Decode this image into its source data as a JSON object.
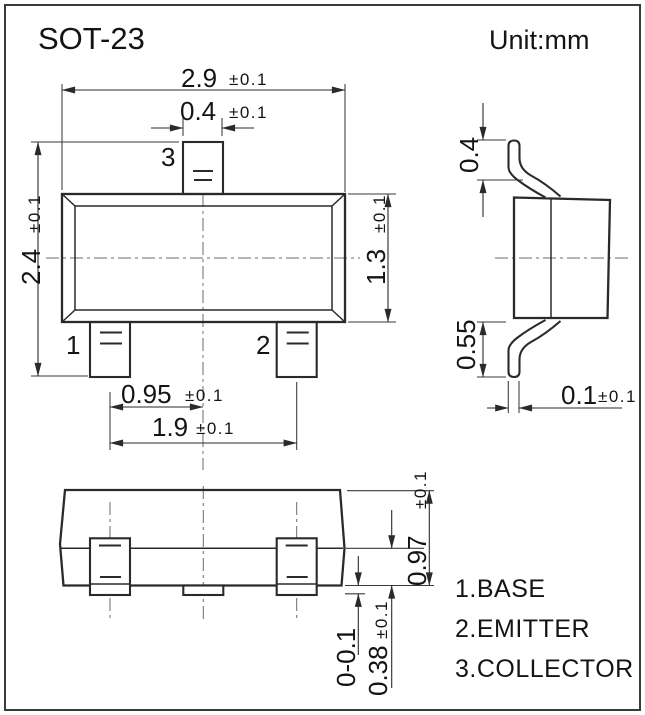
{
  "title": "SOT-23",
  "unit_label": "Unit:mm",
  "colors": {
    "line": "#2a2a2a",
    "text": "#141414",
    "centerline": "#6b6b6b",
    "background": "#ffffff"
  },
  "pins": [
    {
      "number": "1",
      "name": "BASE",
      "legend": "1.BASE"
    },
    {
      "number": "2",
      "name": "EMITTER",
      "legend": "2.EMITTER"
    },
    {
      "number": "3",
      "name": "COLLECTOR",
      "legend": "3.COLLECTOR"
    }
  ],
  "dims": {
    "body_width": {
      "value": "2.9",
      "tol": "±0.1"
    },
    "pin_width": {
      "value": "0.4",
      "tol": "±0.1"
    },
    "overall_height": {
      "value": "2.4",
      "tol": "±0.1"
    },
    "body_depth": {
      "value": "1.3",
      "tol": "±0.1"
    },
    "pin_pitch": {
      "value": "0.95",
      "tol": "±0.1"
    },
    "pin_span": {
      "value": "1.9",
      "tol": "±0.1"
    },
    "lead_tip": {
      "value": "0.4",
      "tol": ""
    },
    "lead_bend": {
      "value": "0.55",
      "tol": ""
    },
    "lead_thickness": {
      "value": "0.1",
      "tol": "±0.1"
    },
    "body_height": {
      "value": "0.97",
      "tol": "±0.1"
    },
    "lead_height": {
      "value": "0.38",
      "tol": "±0.1"
    },
    "standoff": {
      "value": "0-0.1",
      "tol": ""
    }
  }
}
